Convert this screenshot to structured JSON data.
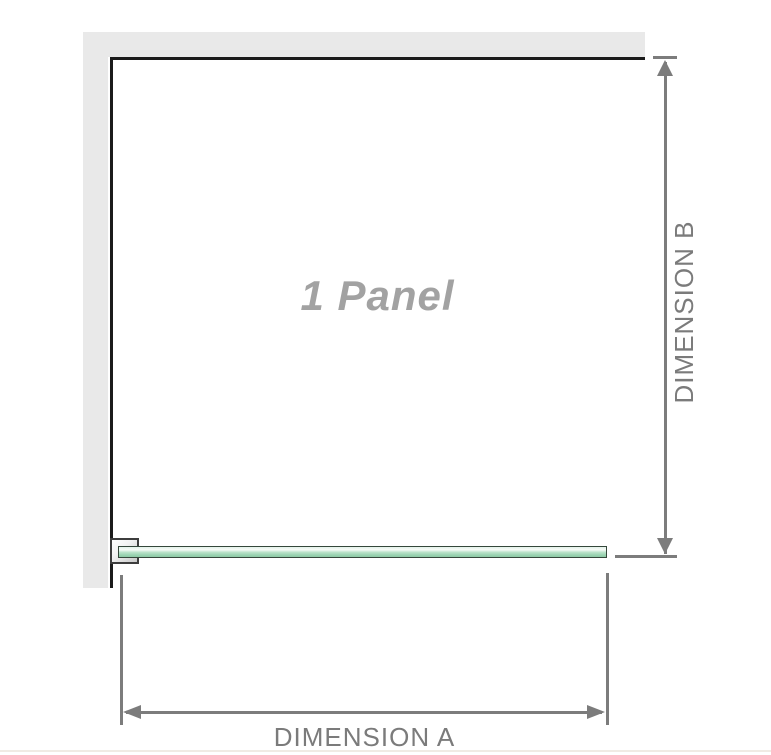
{
  "diagram": {
    "panel_label": "1 Panel",
    "dimension_a_label": "DIMENSION A",
    "dimension_b_label": "DIMENSION B"
  },
  "colors": {
    "wall": "#e9e9e9",
    "frame": "#1b1b1b",
    "dimension": "#7c7c7c",
    "label_text": "#7b7b7b",
    "panel_text": "#a2a2a2",
    "glass_border": "#35473b",
    "glass_fill_light": "#e4f2e9",
    "glass_fill_mid": "#9cd4b3",
    "bracket_border": "#3d3d3d",
    "bottom_edge": "#f0ebe4"
  }
}
